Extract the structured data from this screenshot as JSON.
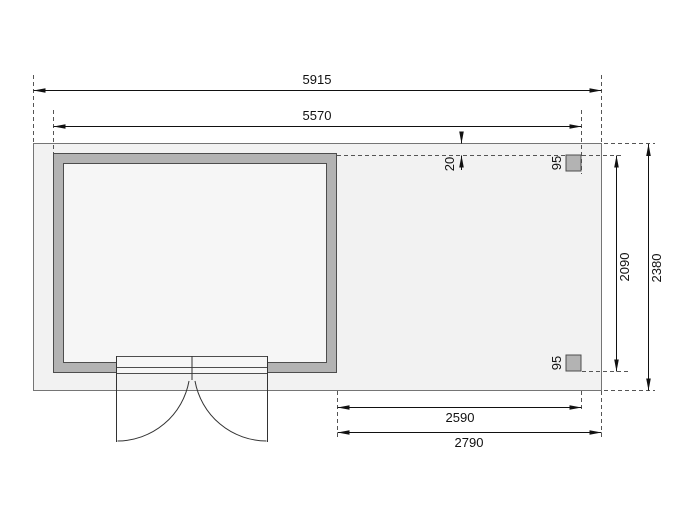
{
  "drawing": {
    "type": "floor-plan",
    "description": "Garden house floor plan with side annex, two posts and outward-swinging double door",
    "dims": {
      "overall_width": "5915",
      "body_width": "5570",
      "outer_depth": "2380",
      "inner_depth": "2090",
      "edge_offset": "20",
      "post_top": "95",
      "post_bottom": "95",
      "annex_inner_width": "2590",
      "annex_outer_width": "2790"
    },
    "colors": {
      "floor_fill": "#f2f2f2",
      "inner_fill": "#f6f6f6",
      "wall_fill": "#b3b3b3",
      "wall_outline": "#4d4d4d",
      "dimension_line": "#111111",
      "extension_line": "#555555"
    }
  }
}
